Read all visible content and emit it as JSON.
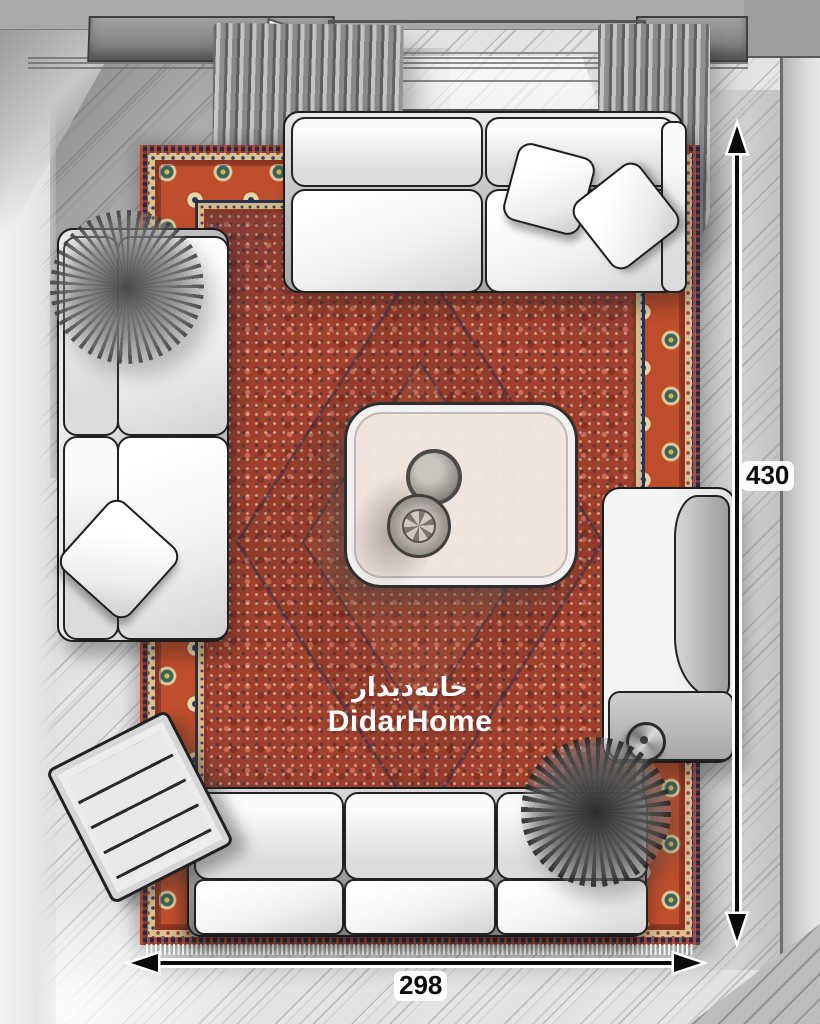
{
  "scene": {
    "type": "living-room-top-view-plan",
    "watermark": {
      "brand_fa": "خانه‌دیدار",
      "brand_en": "DidarHome"
    },
    "dimensions": {
      "length_label": "430",
      "width_label": "298"
    },
    "icons": {
      "vertical_dimension": "double-arrow-vertical-icon",
      "horizontal_dimension": "double-arrow-horizontal-icon"
    },
    "colors": {
      "rug_field": "#a1402d",
      "rug_main_border": "#bf4e2c",
      "rug_guard_navy": "#2c3050",
      "rug_cream": "#d8c394",
      "floor": "#e2e2e2",
      "wall": "#a9a9a9",
      "sofa_light": "#f2f2f2",
      "sofa_dark": "#8b8b8b",
      "outline": "#1c1c1c",
      "dimension_line": "#0b0b0b",
      "watermark_text": "#ffffff"
    }
  }
}
